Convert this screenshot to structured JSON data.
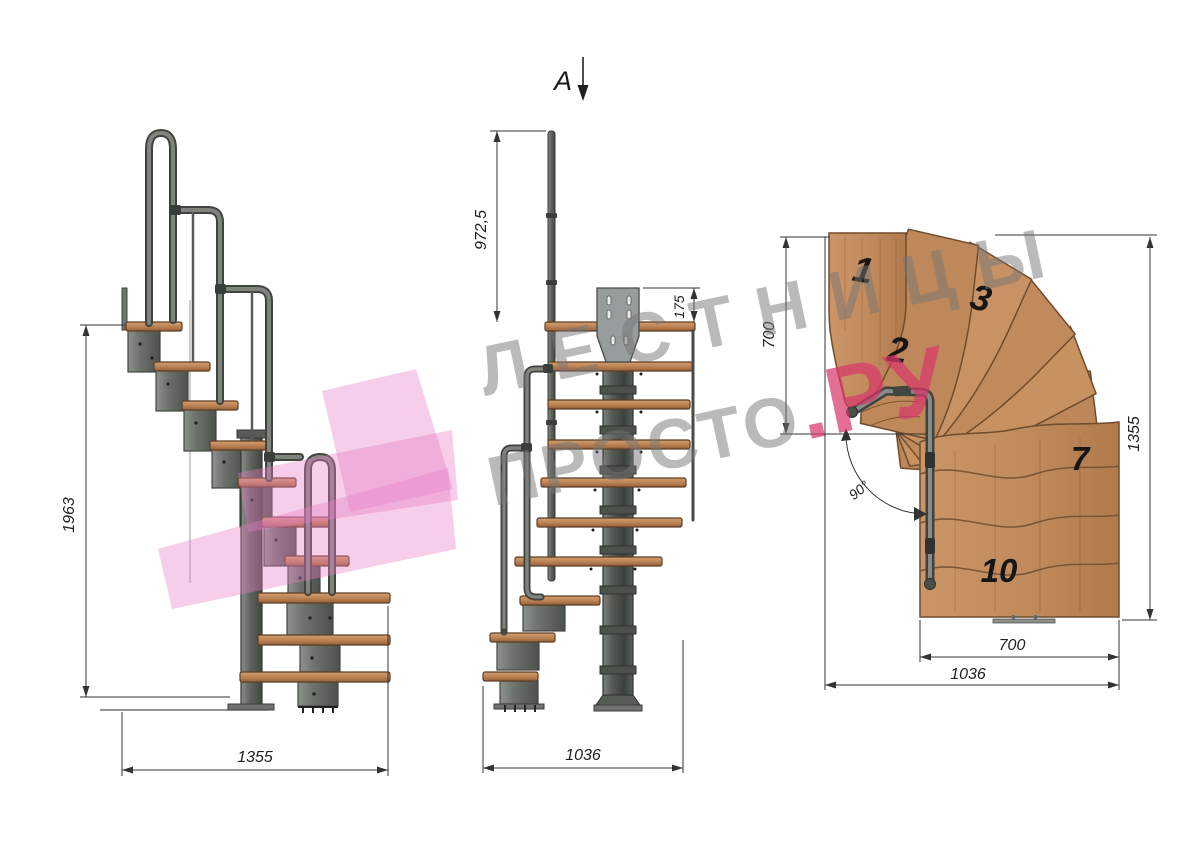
{
  "watermark": {
    "line1": "ЛЕСТНИЦЫ",
    "line2_main": "ПРОСТО",
    "line2_accent": ".РУ",
    "accent_color": "#d8386b"
  },
  "side_view": {
    "height_dim": "1963",
    "width_dim": "1355"
  },
  "front_view": {
    "section_label": "A",
    "post_height_dim": "972,5",
    "plate_dim": "175",
    "width_dim": "1036"
  },
  "plan_view": {
    "left_dim": "700",
    "right_dim": "1355",
    "inner_width_dim": "700",
    "outer_width_dim": "1036",
    "angle_dim": "90°",
    "treads": [
      "1",
      "2",
      "3",
      "7",
      "10"
    ]
  },
  "colors": {
    "wood": "#c08a5c",
    "metal": "#6e736e",
    "pink_logo": "#e87fc6",
    "dim_line": "#333333"
  }
}
